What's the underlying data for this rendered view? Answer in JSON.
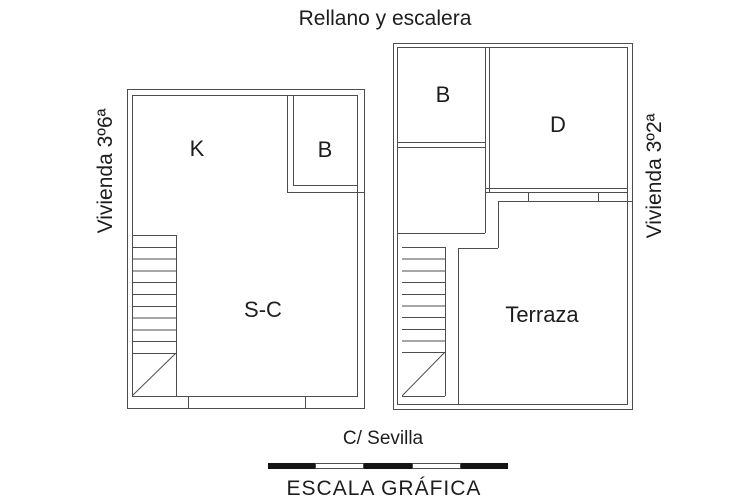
{
  "header": {
    "title": "Rellano y escalera"
  },
  "units": {
    "left": {
      "name": "Vivienda 3º6ª",
      "rooms": {
        "k": "K",
        "b": "B",
        "sc": "S-C"
      }
    },
    "right": {
      "name": "Vivienda 3º2ª",
      "rooms": {
        "b": "B",
        "d": "D",
        "terrace": "Terraza"
      }
    }
  },
  "footer": {
    "street": "C/ Sevilla",
    "scale_label": "ESCALA GRÁFICA"
  },
  "colors": {
    "wall": "#4d4d4d",
    "text": "#1d1d1d",
    "scale_black": "#151515",
    "background": "#ffffff"
  }
}
